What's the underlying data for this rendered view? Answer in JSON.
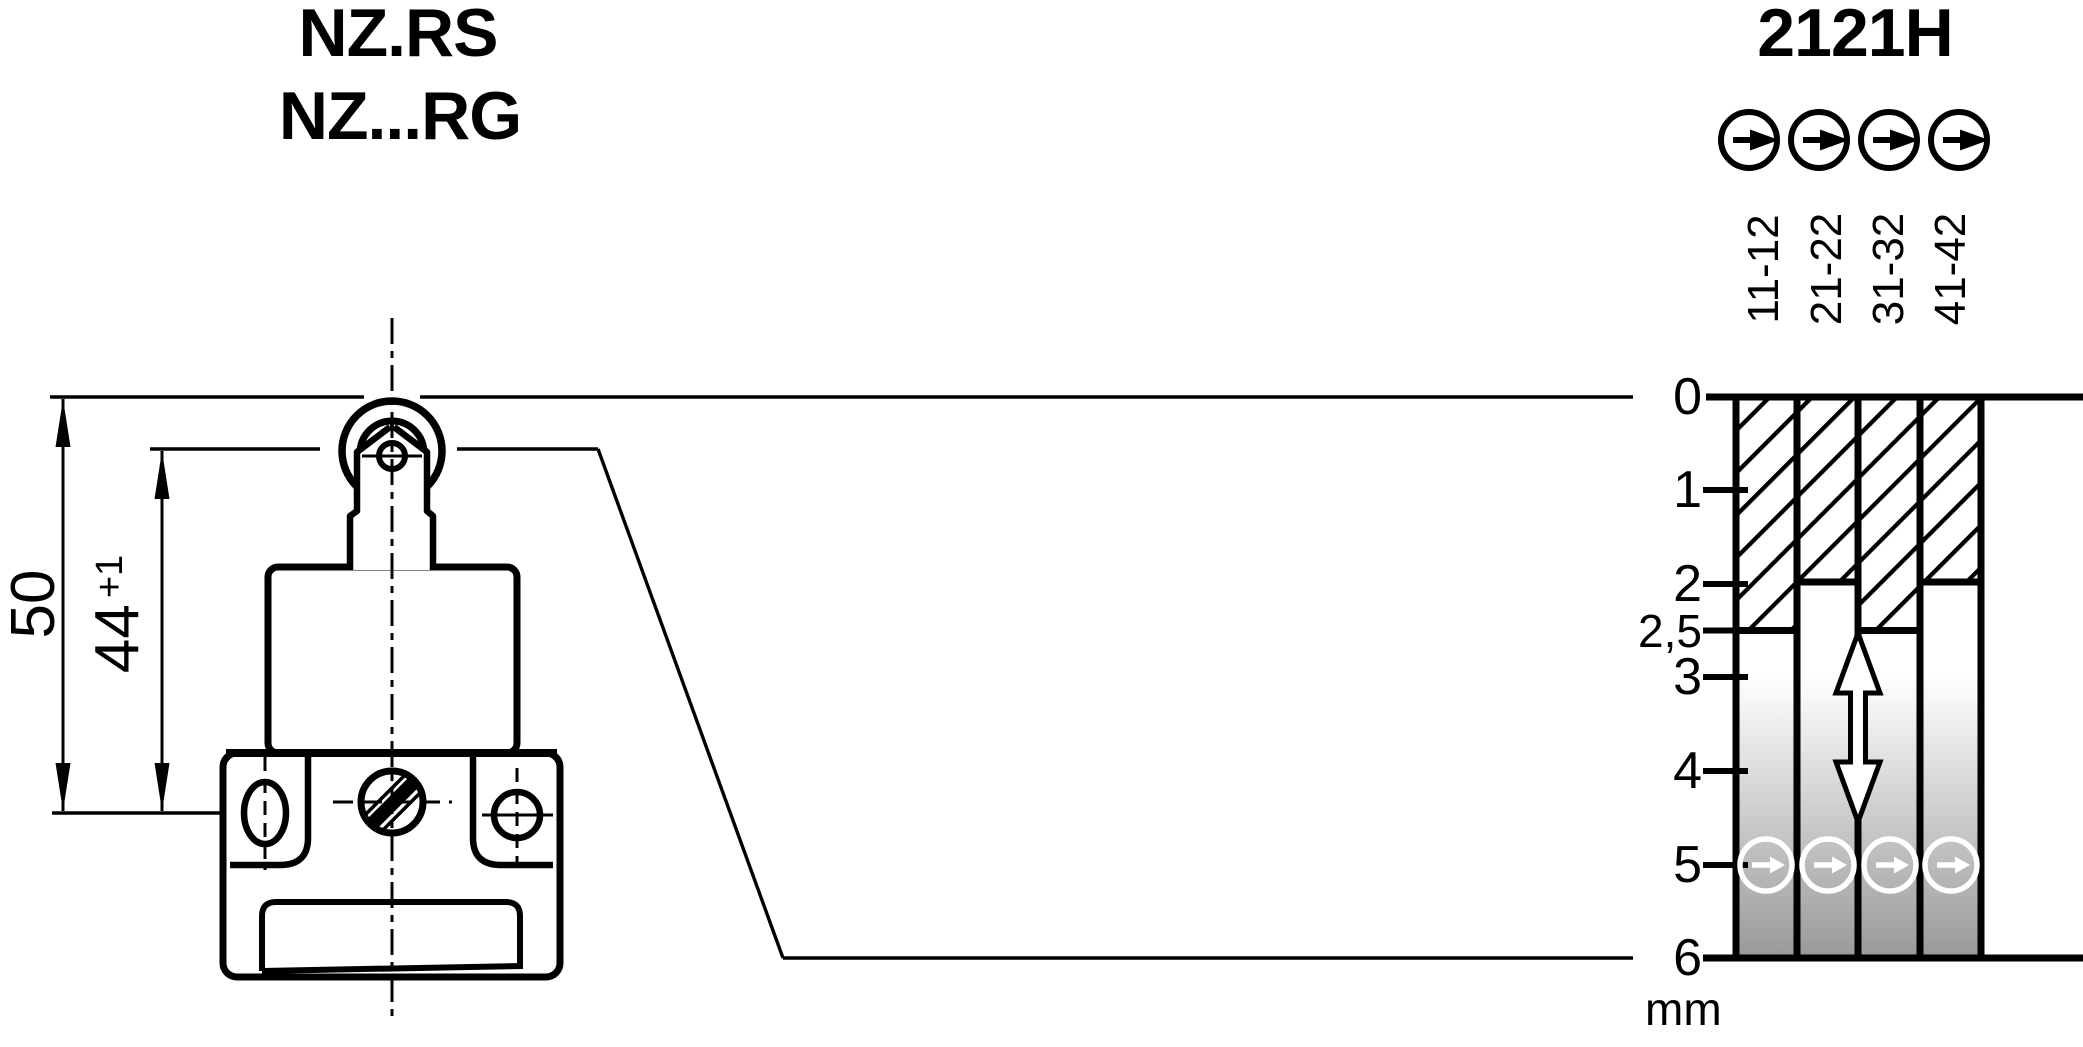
{
  "page": {
    "background": "#ffffff",
    "ink": "#000000",
    "shade_gray": "#999999"
  },
  "device_drawing": {
    "models": [
      "NZ.RS",
      "NZ...RG"
    ],
    "dimensions": {
      "total_height": {
        "value": "50"
      },
      "body_height": {
        "value": "44",
        "tolerance": "+1"
      }
    }
  },
  "travel_diagram": {
    "title": "2121H",
    "unit": "mm",
    "scale_range_mm": [
      0,
      6
    ],
    "scale_tick_labels": [
      "0",
      "1",
      "2",
      "2,5",
      "3",
      "4",
      "5",
      "6"
    ],
    "contacts": [
      {
        "label": "11-12",
        "closed_hatch_to_mm": 2.5
      },
      {
        "label": "21-22",
        "closed_hatch_to_mm": 2
      },
      {
        "label": "31-32",
        "closed_hatch_to_mm": 2.5
      },
      {
        "label": "41-42",
        "closed_hatch_to_mm": 2
      }
    ],
    "positive_opening_point_mm": 5,
    "travel_arrow_span_mm": [
      2.5,
      4.5
    ]
  }
}
